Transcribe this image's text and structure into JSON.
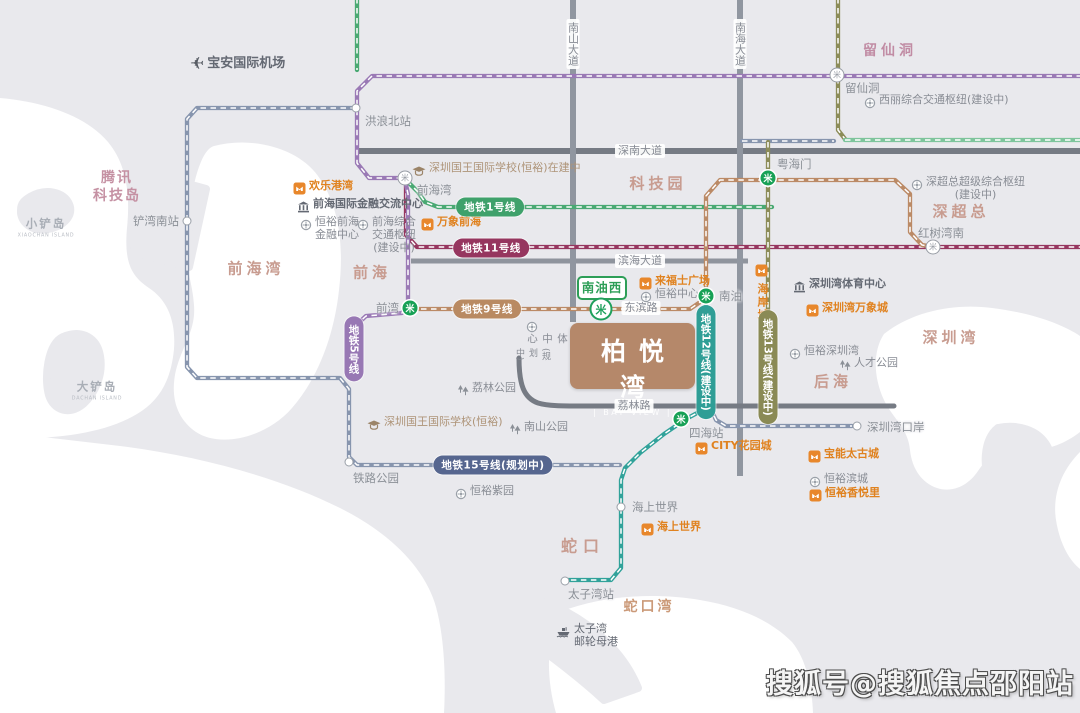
{
  "map": {
    "watermark": "搜狐号@搜狐焦点邵阳站",
    "bayview": {
      "title": "柏悦湾",
      "subtitle": "| BAY VIEW |"
    },
    "nanyouxi": {
      "label": "南油西"
    },
    "icons": {
      "metro_glyph": "米",
      "plane_glyph": "✈"
    },
    "colors": {
      "land": "#e9e9ed",
      "water": "#ffffff",
      "line1": "#4aa973",
      "line5": "#9a79b5",
      "line9": "#bb8a66",
      "line11": "#96365f",
      "line12": "#31a29a",
      "line13": "#8c8c58",
      "line15": "#8795ae",
      "orange": "#e0821f",
      "area": "#c89c90",
      "bayview_bg": "#b5886a",
      "metro_green": "#17a156"
    },
    "roads": [
      {
        "name": "shennan-avenue",
        "x1": 357,
        "y1": 151,
        "x2": 1082,
        "y2": 151,
        "w": 6,
        "c": "#767b84"
      },
      {
        "name": "binhai-avenue",
        "x1": 411,
        "y1": 261,
        "x2": 748,
        "y2": 261,
        "w": 5,
        "c": "#8f949d"
      },
      {
        "name": "nanshan-avenue",
        "x1": 573,
        "y1": -2,
        "x2": 573,
        "y2": 322,
        "w": 6,
        "c": "#9096a0"
      },
      {
        "name": "nanhai-avenue",
        "x1": 740,
        "y1": -2,
        "x2": 740,
        "y2": 476,
        "w": 6,
        "c": "#9096a0"
      },
      {
        "name": "lilin-road",
        "path": "M519,358 C519,385 524,398 538,403 C548,406 562,406 582,406 L894,406",
        "w": 5,
        "c": "#767b84"
      }
    ],
    "road_labels": [
      {
        "text": "深南大道",
        "x": 640,
        "y": 151
      },
      {
        "text": "滨海大道",
        "x": 640,
        "y": 261
      },
      {
        "text": "荔林路",
        "x": 634,
        "y": 406
      },
      {
        "text": "东滨路",
        "x": 641,
        "y": 308
      },
      {
        "text": "南山大道",
        "x": 573,
        "y": 44,
        "vertical": true
      },
      {
        "text": "南海大道",
        "x": 740,
        "y": 44,
        "vertical": true
      }
    ],
    "metro_lines": [
      {
        "id": "line-15-planned",
        "color": "#8795ae",
        "path": [
          [
            356,
            108
          ],
          [
            197,
            108
          ],
          [
            187,
            119
          ],
          [
            187,
            367
          ],
          [
            197,
            378
          ],
          [
            340,
            378
          ],
          [
            349,
            389
          ],
          [
            349,
            457
          ],
          [
            357,
            465
          ],
          [
            620,
            465
          ]
        ]
      },
      {
        "id": "line-5-north",
        "color": "#9a79b5",
        "path": [
          [
            1082,
            76
          ],
          [
            372,
            76
          ],
          [
            357,
            91
          ],
          [
            357,
            163
          ],
          [
            369,
            178
          ],
          [
            402,
            178
          ]
        ]
      },
      {
        "id": "line-1-airport",
        "color": "#4aa973",
        "path": [
          [
            357,
            -2
          ],
          [
            357,
            70
          ]
        ]
      },
      {
        "id": "line-1",
        "color": "#4aa973",
        "path": [
          [
            407,
            181
          ],
          [
            418,
            192
          ],
          [
            425,
            202
          ],
          [
            438,
            207
          ],
          [
            772,
            207
          ]
        ]
      },
      {
        "id": "line-11",
        "color": "#96365f",
        "path": [
          [
            406,
            183
          ],
          [
            406,
            235
          ],
          [
            417,
            247
          ],
          [
            1082,
            247
          ]
        ]
      },
      {
        "id": "line-5-south",
        "color": "#9a79b5",
        "path": [
          [
            405,
            180
          ],
          [
            408,
            194
          ],
          [
            408,
            302
          ],
          [
            402,
            313
          ],
          [
            366,
            316
          ],
          [
            354,
            327
          ],
          [
            354,
            376
          ]
        ]
      },
      {
        "id": "line-13-north",
        "color": "#8c8c58",
        "path": [
          [
            838,
            -2
          ],
          [
            838,
            130
          ],
          [
            845,
            139
          ]
        ]
      },
      {
        "id": "line-13-east",
        "color": "#7ec49c",
        "path": [
          [
            845,
            140
          ],
          [
            1082,
            140
          ]
        ]
      },
      {
        "id": "line-13-link",
        "color": "#8795ae",
        "path": [
          [
            742,
            141
          ],
          [
            834,
            141
          ]
        ]
      },
      {
        "id": "line-13",
        "color": "#8c8c58",
        "path": [
          [
            768,
            142
          ],
          [
            768,
            413
          ]
        ]
      },
      {
        "id": "line-9",
        "color": "#bb8a66",
        "path": [
          [
            411,
            309
          ],
          [
            690,
            309
          ],
          [
            706,
            298
          ],
          [
            706,
            196
          ],
          [
            720,
            180
          ],
          [
            895,
            180
          ],
          [
            910,
            194
          ],
          [
            910,
            232
          ],
          [
            922,
            245
          ],
          [
            934,
            247
          ]
        ]
      },
      {
        "id": "line-12",
        "color": "#31a29a",
        "path": [
          [
            706,
            298
          ],
          [
            706,
            400
          ],
          [
            699,
            412
          ],
          [
            686,
            419
          ],
          [
            664,
            434
          ],
          [
            640,
            453
          ],
          [
            625,
            468
          ],
          [
            621,
            480
          ],
          [
            621,
            568
          ],
          [
            611,
            580
          ],
          [
            567,
            580
          ]
        ]
      },
      {
        "id": "shenzhen-bay-port-spur",
        "color": "#8795ae",
        "path": [
          [
            710,
            407
          ],
          [
            716,
            420
          ],
          [
            726,
            426
          ],
          [
            852,
            426
          ]
        ]
      }
    ],
    "pills": [
      {
        "text": "地铁1号线",
        "x": 490,
        "y": 207,
        "bg": "#3fa16b"
      },
      {
        "text": "地铁11号线",
        "x": 491,
        "y": 248,
        "bg": "#96365f"
      },
      {
        "text": "地铁9号线",
        "x": 487,
        "y": 309,
        "bg": "#b98a62"
      },
      {
        "text": "地铁5号线",
        "x": 354,
        "y": 349,
        "bg": "#9878b4",
        "vertical": true
      },
      {
        "text": "地铁15号线(规划中)",
        "x": 493,
        "y": 465,
        "bg": "#56668f"
      },
      {
        "text": "地铁12号线(建设中)",
        "x": 706,
        "y": 362,
        "bg": "#2f9e96",
        "vertical": true
      },
      {
        "text": "地铁13号线(建设中)",
        "x": 768,
        "y": 367,
        "bg": "#8a8a55",
        "vertical": true
      }
    ],
    "stations": [
      {
        "label": "洪浪北站",
        "x": 356,
        "y": 108,
        "type": "plain",
        "lx": 365,
        "ly": 121,
        "anchor": "left"
      },
      {
        "label": "铲湾南站",
        "x": 187,
        "y": 221,
        "type": "plain",
        "lx": 179,
        "ly": 221,
        "anchor": "right"
      },
      {
        "label": "前海湾",
        "x": 405,
        "y": 178,
        "type": "hub",
        "lx": 417,
        "ly": 190,
        "anchor": "left"
      },
      {
        "label": "留仙洞",
        "x": 837,
        "y": 75,
        "type": "hub",
        "lx": 845,
        "ly": 88,
        "anchor": "left"
      },
      {
        "label": "前湾",
        "x": 410,
        "y": 308,
        "type": "green",
        "lx": 399,
        "ly": 308,
        "anchor": "right"
      },
      {
        "label": "南油",
        "x": 706,
        "y": 296,
        "type": "green",
        "lx": 719,
        "ly": 296,
        "anchor": "left"
      },
      {
        "label": "粤海门",
        "x": 768,
        "y": 178,
        "type": "green",
        "lx": 777,
        "ly": 164,
        "anchor": "left"
      },
      {
        "label": "红树湾南",
        "x": 933,
        "y": 247,
        "type": "hub",
        "lx": 918,
        "ly": 233,
        "anchor": "left"
      },
      {
        "label": "四海站",
        "x": 681,
        "y": 419,
        "type": "green",
        "lx": 689,
        "ly": 433,
        "anchor": "left"
      },
      {
        "label": "铁路公园",
        "x": 349,
        "y": 462,
        "type": "plain",
        "lx": 353,
        "ly": 478,
        "anchor": "left"
      },
      {
        "label": "海上世界",
        "x": 621,
        "y": 507,
        "type": "plain",
        "lx": 632,
        "ly": 507,
        "anchor": "left"
      },
      {
        "label": "太子湾站",
        "x": 565,
        "y": 581,
        "type": "plain",
        "lx": 568,
        "ly": 594,
        "anchor": "left"
      },
      {
        "label": "深圳湾口岸",
        "x": 857,
        "y": 426,
        "type": "plain",
        "lx": 867,
        "ly": 427,
        "anchor": "left"
      }
    ],
    "areas": [
      {
        "lines": [
          "腾讯",
          "科技岛"
        ],
        "x": 117,
        "y": 187,
        "size": 14,
        "color": "#c591a3",
        "ls": 2
      },
      {
        "lines": [
          "小铲岛"
        ],
        "x": 46,
        "y": 228,
        "size": 11.5,
        "color": "#a9aeb6",
        "ls": 2,
        "sub": "XIAOCHAN ISLAND"
      },
      {
        "lines": [
          "大铲岛"
        ],
        "x": 97,
        "y": 391,
        "size": 11.5,
        "color": "#a9aeb6",
        "ls": 2,
        "sub": "DACHAN ISLAND"
      },
      {
        "lines": [
          "前海湾"
        ],
        "x": 256,
        "y": 269,
        "size": 15,
        "color": "#c89c90",
        "ls": 4
      },
      {
        "lines": [
          "前海"
        ],
        "x": 372,
        "y": 273,
        "size": 15,
        "color": "#c89c90",
        "ls": 4
      },
      {
        "lines": [
          "科技园"
        ],
        "x": 658,
        "y": 184,
        "size": 15,
        "color": "#c89c90",
        "ls": 4
      },
      {
        "lines": [
          "留仙洞"
        ],
        "x": 890,
        "y": 51,
        "size": 14,
        "color": "#c18ca4",
        "ls": 4
      },
      {
        "lines": [
          "深超总"
        ],
        "x": 961,
        "y": 212,
        "size": 15,
        "color": "#c89c90",
        "ls": 4
      },
      {
        "lines": [
          "后海"
        ],
        "x": 833,
        "y": 382,
        "size": 15,
        "color": "#c89c90",
        "ls": 4
      },
      {
        "lines": [
          "深圳湾"
        ],
        "x": 951,
        "y": 338,
        "size": 15,
        "color": "#c89c90",
        "ls": 4
      },
      {
        "lines": [
          "蛇口"
        ],
        "x": 583,
        "y": 547,
        "size": 16,
        "color": "#c89c90",
        "ls": 6
      },
      {
        "lines": [
          "蛇口湾"
        ],
        "x": 649,
        "y": 607,
        "size": 14,
        "color": "#cb9a79",
        "ls": 3
      }
    ],
    "landmarks": [
      {
        "type": "plane",
        "lines": [
          "宝安国际机场"
        ],
        "x": 190,
        "y": 62,
        "cls": "c-dark bold",
        "size": 13
      },
      {
        "type": "orange",
        "lines": [
          "欢乐港湾"
        ],
        "x": 293,
        "y": 186
      },
      {
        "type": "bldg",
        "lines": [
          "前海国际金融交流中心"
        ],
        "x": 297,
        "y": 204
      },
      {
        "type": "dot",
        "lines": [
          "恒裕前海",
          "金融中心"
        ],
        "x": 300,
        "y": 222,
        "center": true
      },
      {
        "type": "dot",
        "lines": [
          "前海综合",
          "交通枢纽",
          "(建设中)"
        ],
        "x": 357,
        "y": 222,
        "center": true
      },
      {
        "type": "orange",
        "lines": [
          "万象前海"
        ],
        "x": 421,
        "y": 222
      },
      {
        "type": "school",
        "lines": [
          "深圳国王国际学校(恒裕)在建中"
        ],
        "x": 412,
        "y": 168
      },
      {
        "type": "orange",
        "lines": [
          "来福士广场"
        ],
        "x": 639,
        "y": 281
      },
      {
        "type": "dot",
        "lines": [
          "恒裕中心"
        ],
        "x": 640,
        "y": 294
      },
      {
        "type": "orange",
        "lines": [
          "海岸城"
        ],
        "x": 755,
        "y": 268,
        "vertical": true
      },
      {
        "type": "bldg",
        "lines": [
          "深圳湾体育中心"
        ],
        "x": 793,
        "y": 284
      },
      {
        "type": "orange",
        "lines": [
          "深圳湾万象城"
        ],
        "x": 806,
        "y": 308
      },
      {
        "type": "dot",
        "lines": [
          "深超总超级综合枢纽",
          "(建设中)"
        ],
        "x": 911,
        "y": 182,
        "center": true
      },
      {
        "type": "dot",
        "lines": [
          "西丽综合交通枢纽(建设中)"
        ],
        "x": 864,
        "y": 100
      },
      {
        "type": "dot",
        "lines": [
          "恒裕深圳湾"
        ],
        "x": 789,
        "y": 351
      },
      {
        "type": "tree",
        "lines": [
          "人才公园"
        ],
        "x": 839,
        "y": 363
      },
      {
        "type": "tree",
        "lines": [
          "荔林公园"
        ],
        "x": 457,
        "y": 388
      },
      {
        "type": "school",
        "lines": [
          "深圳国王国际学校(恒裕)"
        ],
        "x": 367,
        "y": 422
      },
      {
        "type": "tree",
        "lines": [
          "南山公园"
        ],
        "x": 509,
        "y": 427
      },
      {
        "type": "orange",
        "lines": [
          "CITY花园城"
        ],
        "x": 695,
        "y": 446
      },
      {
        "type": "orange",
        "lines": [
          "宝能太古城"
        ],
        "x": 808,
        "y": 454
      },
      {
        "type": "dot",
        "lines": [
          "恒裕紫园"
        ],
        "x": 455,
        "y": 491
      },
      {
        "type": "dot",
        "lines": [
          "恒裕滨城"
        ],
        "x": 809,
        "y": 479
      },
      {
        "type": "orange",
        "lines": [
          "恒裕香悦里"
        ],
        "x": 809,
        "y": 493
      },
      {
        "type": "orange",
        "lines": [
          "海上世界"
        ],
        "x": 641,
        "y": 527
      },
      {
        "type": "ship",
        "lines": [
          "太子湾",
          "邮轮母港"
        ],
        "x": 556,
        "y": 629
      }
    ],
    "culture_center": {
      "main": "南山街道文体中心",
      "side": "(规划中)",
      "x": 513,
      "y": 318
    }
  }
}
